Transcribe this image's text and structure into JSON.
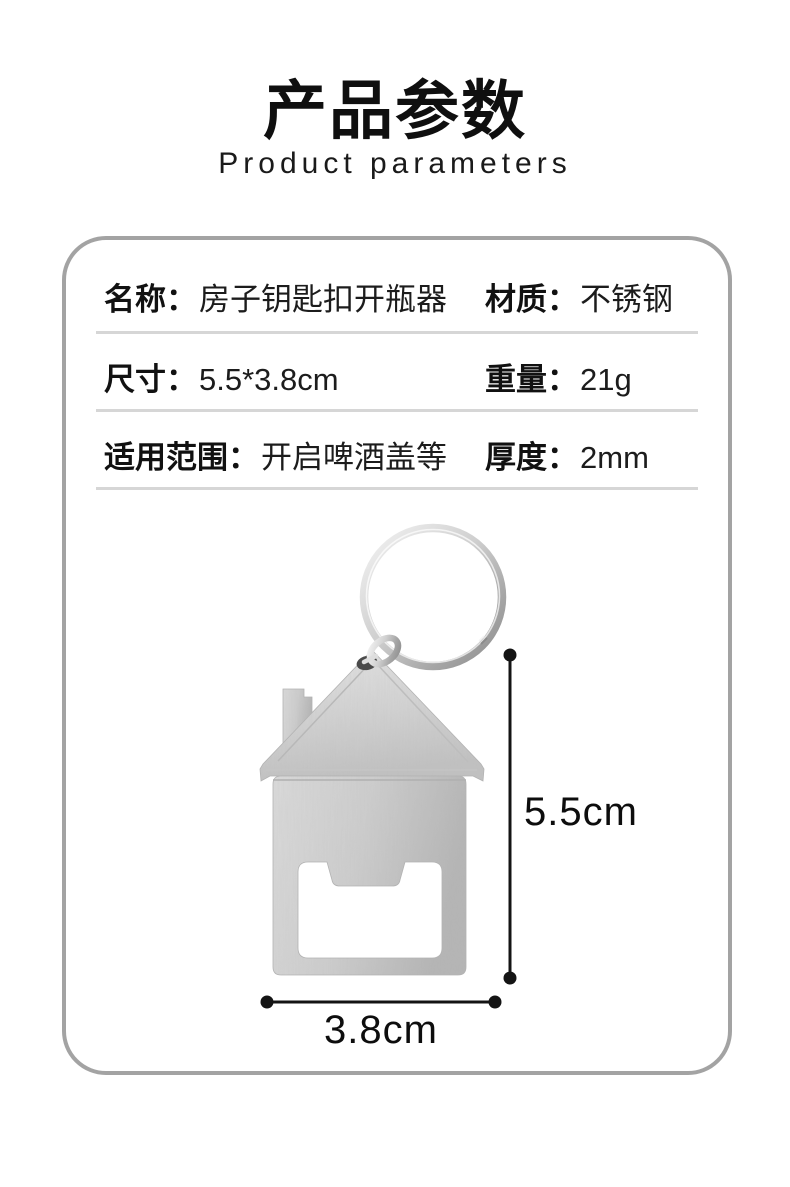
{
  "header": {
    "title": "产品参数",
    "subtitle": "Product parameters"
  },
  "spec_card": {
    "rows": [
      {
        "left_label": "名称：",
        "left_value": "房子钥匙扣开瓶器",
        "right_label": "材质：",
        "right_value": "不锈钢"
      },
      {
        "left_label": "尺寸：",
        "left_value": "5.5*3.8cm",
        "right_label": "重量：",
        "right_value": "21g"
      },
      {
        "left_label": "适用范围：",
        "left_value": "开启啤酒盖等",
        "right_label": "厚度：",
        "right_value": "2mm"
      }
    ]
  },
  "figure": {
    "image_alt": "house-shaped-keychain-bottle-opener-with-keyring",
    "height_label": "5.5cm",
    "width_label": "3.8cm"
  },
  "colors": {
    "card_border": "#a3a3a3",
    "divider": "#d6d6d6",
    "text": "#111111",
    "metal_light": "#e4e4e4",
    "metal_mid": "#cccccc",
    "metal_dark": "#b6b6b6",
    "dimension_line": "#141414"
  }
}
